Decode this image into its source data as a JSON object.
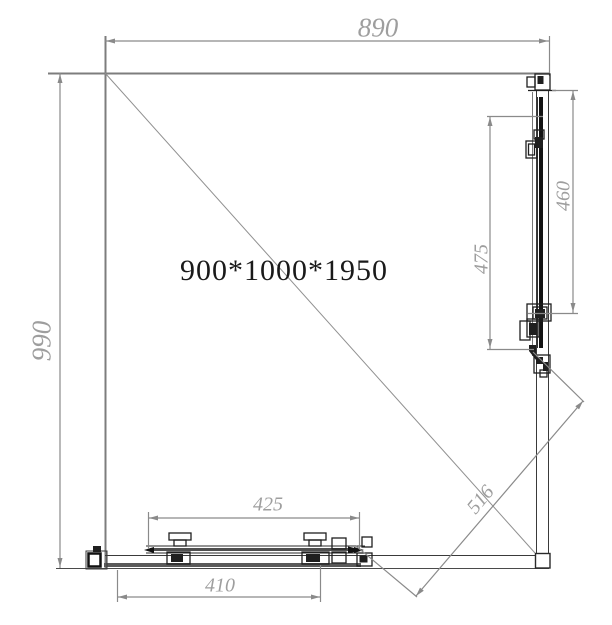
{
  "labels": {
    "size_label": "900*1000*1950",
    "dim_top_width": "890",
    "dim_left_height": "990",
    "dim_right_panel_outer": "460",
    "dim_right_panel_inner": "475",
    "dim_bottom_door_upper": "425",
    "dim_bottom_door_lower": "410",
    "dim_diagonal_opening": "516"
  },
  "colors": {
    "background": "#ffffff",
    "wall_line": "#7d7d7d",
    "dimension_line": "#8a8a8a",
    "dimension_text": "#9e9e9e",
    "hardware_line": "#1f1f1f",
    "size_text": "#1a1a1a"
  }
}
